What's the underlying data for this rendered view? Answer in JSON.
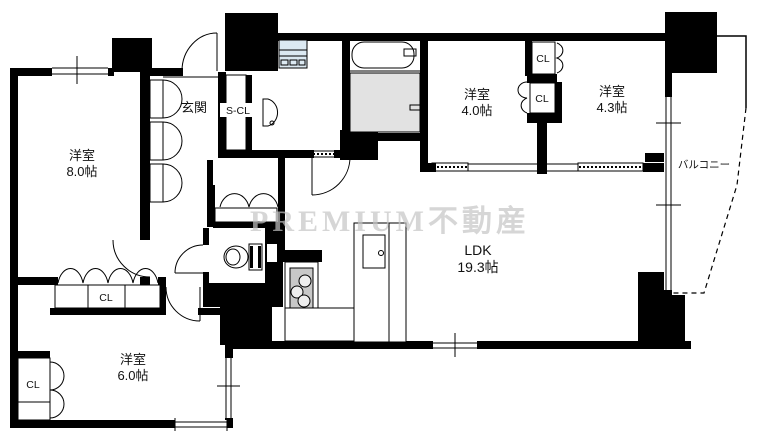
{
  "watermark": "PREMIUM不動産",
  "rooms": {
    "west8": {
      "name": "洋室",
      "size": "8.0帖"
    },
    "west4": {
      "name": "洋室",
      "size": "4.0帖"
    },
    "west43": {
      "name": "洋室",
      "size": "4.3帖"
    },
    "west6": {
      "name": "洋室",
      "size": "6.0帖"
    },
    "ldk": {
      "name": "LDK",
      "size": "19.3帖"
    },
    "genkan": {
      "name": "玄関"
    },
    "balcony": {
      "name": "バルコニー"
    },
    "shoe_closet": {
      "name": "S-CL"
    }
  },
  "closets": {
    "cl_43": "CL",
    "cl_40": "CL",
    "cl_8": "CL",
    "cl_6": "CL"
  },
  "colors": {
    "wall": "#000000",
    "shower_floor": "#e2e2e2",
    "stove": "#c8c8c8",
    "washer": "#dce9f2",
    "watermark": "#c5c5c5"
  }
}
